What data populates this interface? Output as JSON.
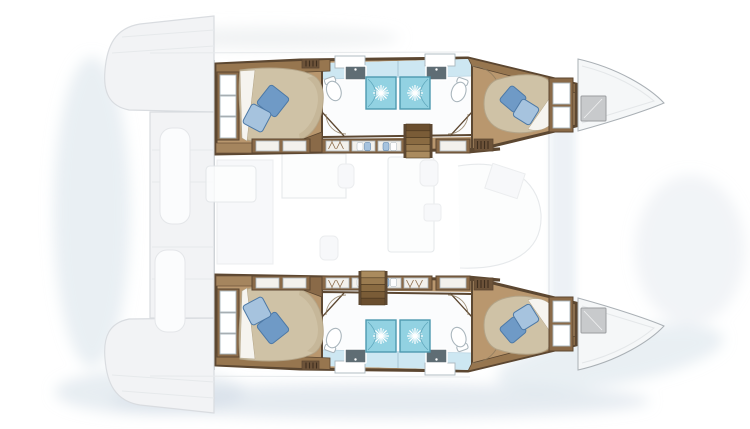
{
  "title": "Catamaran yacht interior layout floor plan, top-down view, bow to the right",
  "scene": {
    "type": "yacht-floorplan",
    "vessel": "catamaran",
    "view": "top-down",
    "orientation": "bow-right",
    "hulls": [
      {
        "id": "port-hull",
        "position": "top",
        "rooms": [
          {
            "name": "aft-cabin",
            "furniture": [
              "double-berth",
              "pillow",
              "pillow",
              "headboard-panels",
              "wardrobe"
            ]
          },
          {
            "name": "aft-bathroom",
            "fixtures": [
              "toilet",
              "sink-vanity",
              "shower"
            ]
          },
          {
            "name": "forward-bathroom",
            "fixtures": [
              "toilet",
              "sink-vanity",
              "shower"
            ]
          },
          {
            "name": "forward-cabin",
            "furniture": [
              "double-berth",
              "pillow",
              "pillow",
              "headboard-panels"
            ]
          }
        ],
        "features": [
          "companionway-stairs",
          "corridor-wardrobes",
          "vent-grates",
          "bow-deck-hatch"
        ]
      },
      {
        "id": "starboard-hull",
        "position": "bottom",
        "rooms": [
          {
            "name": "aft-cabin",
            "furniture": [
              "double-berth",
              "pillow",
              "pillow",
              "headboard-panels",
              "wardrobe"
            ]
          },
          {
            "name": "aft-bathroom",
            "fixtures": [
              "toilet",
              "sink-vanity",
              "shower"
            ]
          },
          {
            "name": "forward-bathroom",
            "fixtures": [
              "toilet",
              "sink-vanity",
              "shower"
            ]
          },
          {
            "name": "forward-cabin",
            "furniture": [
              "double-berth",
              "pillow",
              "pillow",
              "headboard-panels"
            ]
          }
        ],
        "features": [
          "companionway-stairs",
          "corridor-wardrobes",
          "vent-grates",
          "bow-deck-hatch"
        ]
      }
    ],
    "saloon": {
      "rendered": "faded",
      "features": [
        "galley-island",
        "sofa",
        "tables",
        "sinks"
      ]
    },
    "exterior": {
      "rendered": "faded",
      "features": [
        "aft-cockpit",
        "transom-steps",
        "foredeck",
        "bow-hatches"
      ]
    }
  },
  "icons": [
    "shower-spray-icon",
    "hanger-icon",
    "toilet-icon",
    "sink-icon",
    "stairs-icon",
    "vent-grate-icon"
  ],
  "colors": {
    "wood": "#b9976e",
    "wood_dark": "#8a6a48",
    "wall": "#5c4731",
    "cabinet": "#97764f",
    "mattress": "#cfc2a6",
    "mattress_shade": "#bfae8e",
    "mattress_edge": "#b3a488",
    "sheet": "#f6f4ef",
    "pillow_light": "#a6c3de",
    "pillow_dark": "#6f9ac6",
    "pillow_stroke": "#4d79a6",
    "shower": "#92d2e2",
    "shower_stroke": "#4f9ab0",
    "bath_wall": "#cde7f2",
    "bath_floor": "#fbfcfd",
    "fixture_stroke": "#aab6bd",
    "vanity": "#5f6d74",
    "grate": "#6d5339",
    "grate_slit": "#3f2f1e",
    "door_arc": "#8d7a5e",
    "exterior_fill": "#f2f3f5",
    "exterior_stroke": "#d9dce0",
    "faint_stroke": "#e2e5e8",
    "hatch": "#c8cacc",
    "hatch_stroke": "#9b9ea1",
    "bow_line": "#aab0b5",
    "shadow": "#cfdbe5"
  }
}
